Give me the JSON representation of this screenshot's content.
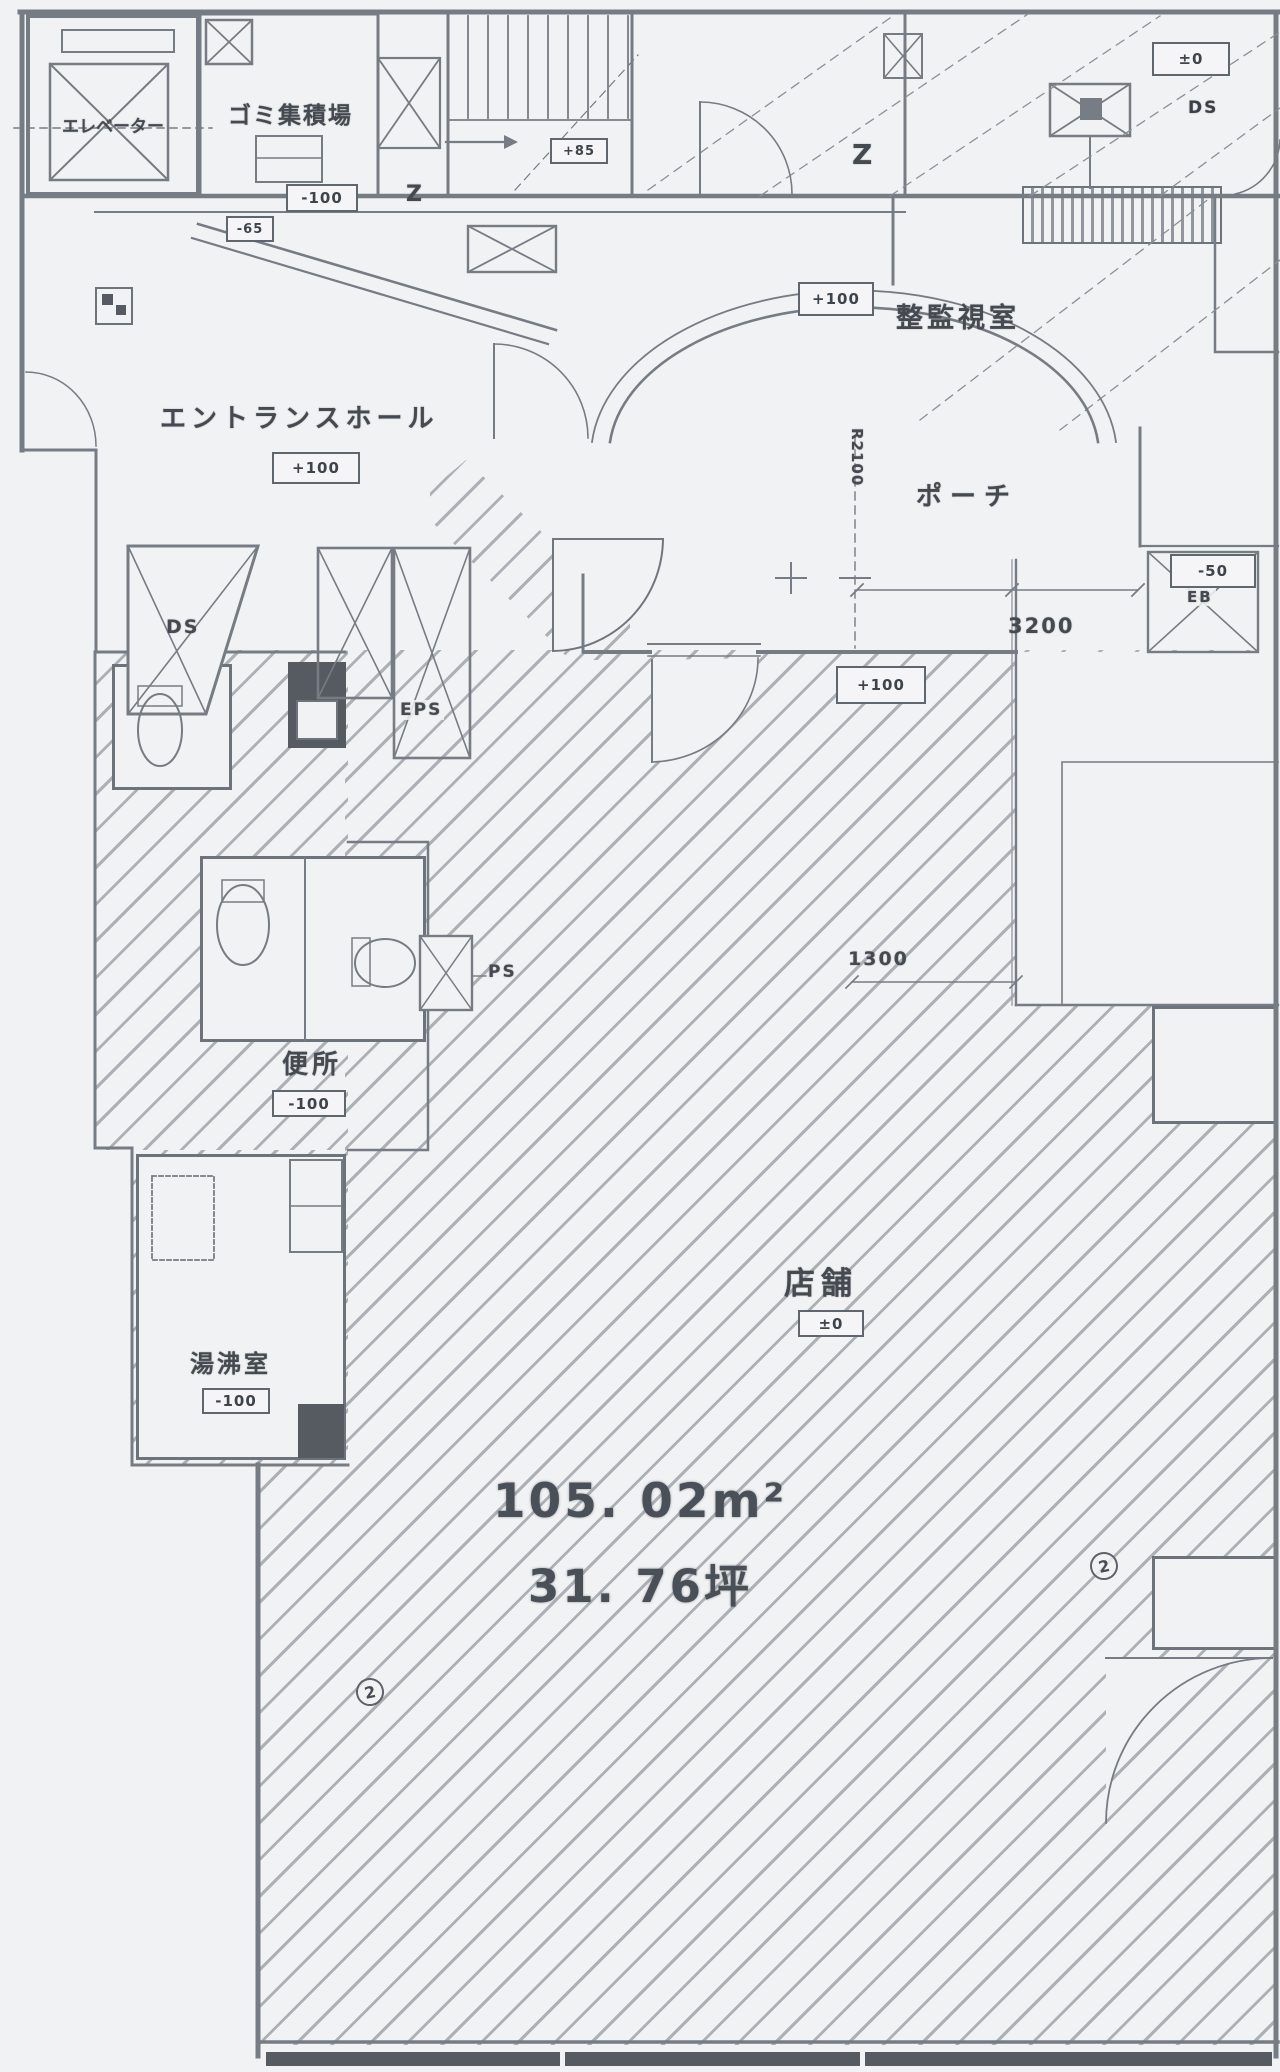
{
  "rooms": {
    "elevator": "エレベーター",
    "garbage": "ゴミ集積場",
    "monitor": "整監視室",
    "entrance": "エントランスホール",
    "porch": "ポーチ",
    "toilet": "便所",
    "hot_water": "湯沸室",
    "store": "店舗"
  },
  "areas": {
    "m2": "105. 02m²",
    "tsubo": "31. 76坪"
  },
  "levels": {
    "garbage": "-100",
    "corridor": "-65",
    "stair": "+85",
    "top_right": "±0",
    "monitor": "+100",
    "entrance": "+100",
    "porch": "+100",
    "right_side": "-50",
    "toilet": "-100",
    "hot_water": "-100",
    "store": "±0"
  },
  "dimensions": {
    "porch_width": "3200",
    "right_width": "1300",
    "arc_radius": "R2100"
  },
  "shafts": {
    "ds": "DS",
    "eps": "EPS",
    "ps": "PS",
    "eb": "EB",
    "ds_top": "DS"
  },
  "marks": {
    "z_large": "Z",
    "z_small": "Z",
    "circle_left": "2",
    "circle_right": "2"
  }
}
